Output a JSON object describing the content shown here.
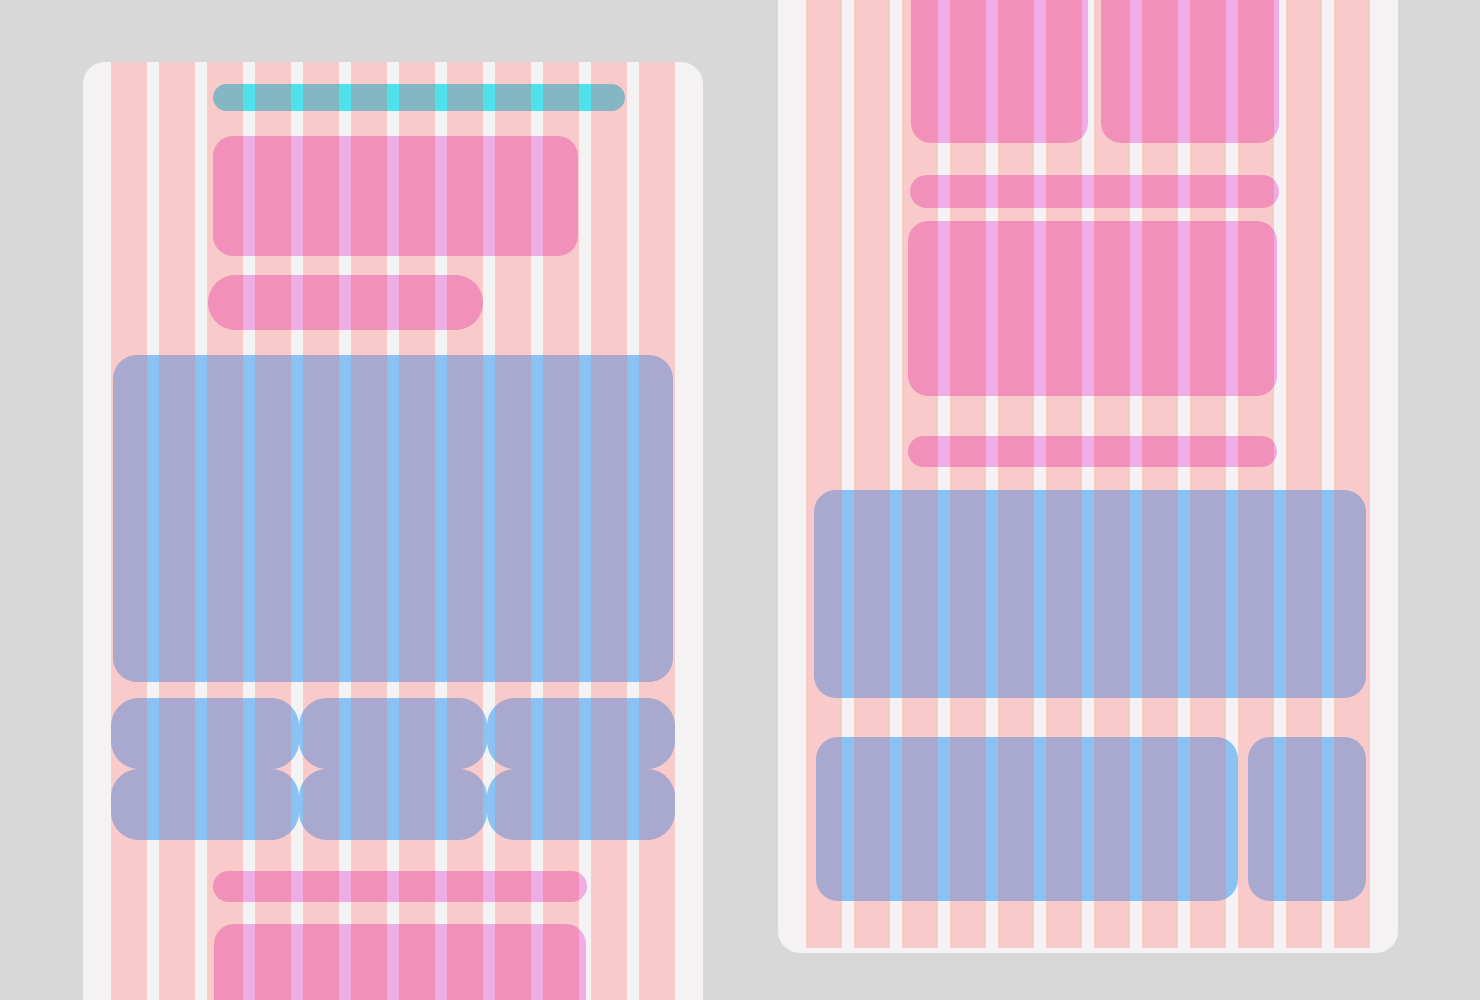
{
  "canvas": {
    "width": 1480,
    "height": 1000,
    "background": "#d8d8d8"
  },
  "grid": {
    "column_width": 36,
    "gutter_width": 12,
    "period": 48,
    "content_inset": 28
  },
  "colors": {
    "page_bg": "#d8d8d8",
    "card_bg": "#f4f2f2",
    "bg_column_salmon": "#f8caca",
    "bg_gutter_white": "#f4f2f2",
    "pink_block": "#f191b9",
    "pink_stripe": "#eeade5",
    "periwinkle_block": "#a9a8ce",
    "periwinkle_stripe": "#8ac2f4",
    "teal_block": "#85b6c3",
    "teal_stripe": "#4ee2ef"
  },
  "fills": {
    "bg": {
      "base": "#f8caca",
      "stripe": "#f4f2f2"
    },
    "pink": {
      "base": "#f191b9",
      "stripe": "#eeade5"
    },
    "peri": {
      "base": "#a9a8ce",
      "stripe": "#8ac2f4"
    },
    "teal": {
      "base": "#85b6c3",
      "stripe": "#4ee2ef"
    }
  },
  "cards": [
    {
      "name": "left-screen-card",
      "x": 83,
      "y": 62,
      "width": 620,
      "height": 980,
      "radius": 22,
      "stripe_top_inset": 0,
      "stripe_bottom_inset": 0,
      "blocks": [
        {
          "name": "teal-toolbar-pill",
          "fill": "teal",
          "x": 102,
          "y": 22,
          "w": 412,
          "h": 27,
          "r": 13.5
        },
        {
          "name": "pink-header-block",
          "fill": "pink",
          "x": 102,
          "y": 74,
          "w": 365,
          "h": 120,
          "r": 20
        },
        {
          "name": "pink-subheader-pill",
          "fill": "pink",
          "x": 97,
          "y": 213,
          "w": 275,
          "h": 55,
          "r": 27.5
        },
        {
          "name": "periwinkle-hero-block",
          "fill": "peri",
          "x": 2,
          "y": 293,
          "w": 560,
          "h": 327,
          "r": 24
        },
        {
          "name": "tile-row-cell",
          "fill": "peri",
          "x": 0,
          "y": 636,
          "w": 188,
          "h": 71,
          "r": 28
        },
        {
          "name": "tile-row-cell",
          "fill": "peri",
          "x": 188,
          "y": 636,
          "w": 188,
          "h": 71,
          "r": 28
        },
        {
          "name": "tile-row-cell",
          "fill": "peri",
          "x": 376,
          "y": 636,
          "w": 188,
          "h": 71,
          "r": 28
        },
        {
          "name": "tile-row-cell",
          "fill": "peri",
          "x": 0,
          "y": 707,
          "w": 188,
          "h": 71,
          "r": 28
        },
        {
          "name": "tile-row-cell",
          "fill": "peri",
          "x": 188,
          "y": 707,
          "w": 188,
          "h": 71,
          "r": 28
        },
        {
          "name": "tile-row-cell",
          "fill": "peri",
          "x": 376,
          "y": 707,
          "w": 188,
          "h": 71,
          "r": 28
        },
        {
          "name": "pink-footer-pill",
          "fill": "pink",
          "x": 102,
          "y": 809,
          "w": 374,
          "h": 31,
          "r": 15.5
        },
        {
          "name": "pink-footer-block",
          "fill": "pink",
          "x": 103,
          "y": 862,
          "w": 372,
          "h": 126,
          "r": 20
        }
      ]
    },
    {
      "name": "right-screen-card",
      "x": 778,
      "y": -70,
      "width": 620,
      "height": 1023,
      "radius": 22,
      "stripe_top_inset": 0,
      "stripe_bottom_inset": 5,
      "blocks": [
        {
          "name": "pink-top-left-block",
          "fill": "pink",
          "x": 105,
          "y": 0,
          "w": 177,
          "h": 213,
          "r": 20
        },
        {
          "name": "pink-top-right-block",
          "fill": "pink",
          "x": 295,
          "y": 0,
          "w": 178,
          "h": 213,
          "r": 20
        },
        {
          "name": "pink-divider-pill",
          "fill": "pink",
          "x": 104,
          "y": 245,
          "w": 369,
          "h": 33,
          "r": 16.5
        },
        {
          "name": "pink-content-block",
          "fill": "pink",
          "x": 102,
          "y": 291,
          "w": 369,
          "h": 175,
          "r": 20
        },
        {
          "name": "pink-divider-pill",
          "fill": "pink",
          "x": 102,
          "y": 506,
          "w": 369,
          "h": 31,
          "r": 15.5
        },
        {
          "name": "periwinkle-hero-block",
          "fill": "peri",
          "x": 8,
          "y": 560,
          "w": 552,
          "h": 208,
          "r": 22
        },
        {
          "name": "periwinkle-wide-block",
          "fill": "peri",
          "x": 10,
          "y": 807,
          "w": 422,
          "h": 164,
          "r": 22
        },
        {
          "name": "periwinkle-narrow-block",
          "fill": "peri",
          "x": 442,
          "y": 807,
          "w": 118,
          "h": 164,
          "r": 22
        }
      ]
    }
  ]
}
